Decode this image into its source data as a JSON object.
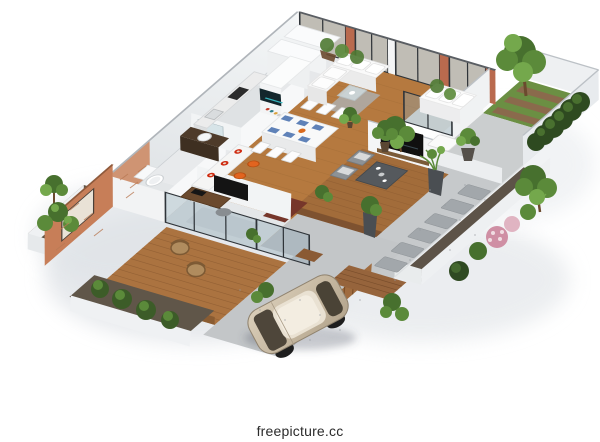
{
  "watermark": {
    "text": "freepicture.cc"
  },
  "scene": {
    "kind": "isometric-3d-floor-plan-render",
    "areas": [
      "living-room",
      "dining-area",
      "kitchen",
      "kitchen-island",
      "bathroom",
      "bedroom-office",
      "media-wall",
      "second-lounge",
      "outdoor-tv-lounge",
      "wood-deck-terrace",
      "front-planters",
      "garden-lawn",
      "hedge-row",
      "gravel-patio",
      "stepping-stone-walk",
      "flower-planter",
      "driveway",
      "parked-car",
      "brick-feature-wall",
      "glass-facade"
    ]
  },
  "palette": {
    "background": "#ffffff",
    "wall": "#eff1f3",
    "wood_floor": "#b5793f",
    "deck_wood": "#ab7340",
    "lounge_deck": "#a26c3a",
    "brick": "#b96a4e",
    "brick_feature": "#c77e58",
    "lawn": "#6b8f43",
    "hedge": "#2e4a20",
    "gravel": "#c6c9cb",
    "concrete": "#cbcecf",
    "driveway": "#c3c6c8",
    "soil": "#605649",
    "car_body": "#c9b8a2",
    "stool": "#e2641f",
    "placemat": "#5f82b8",
    "foliage": "#5b8a3a",
    "runner_rug": "#76362a"
  }
}
